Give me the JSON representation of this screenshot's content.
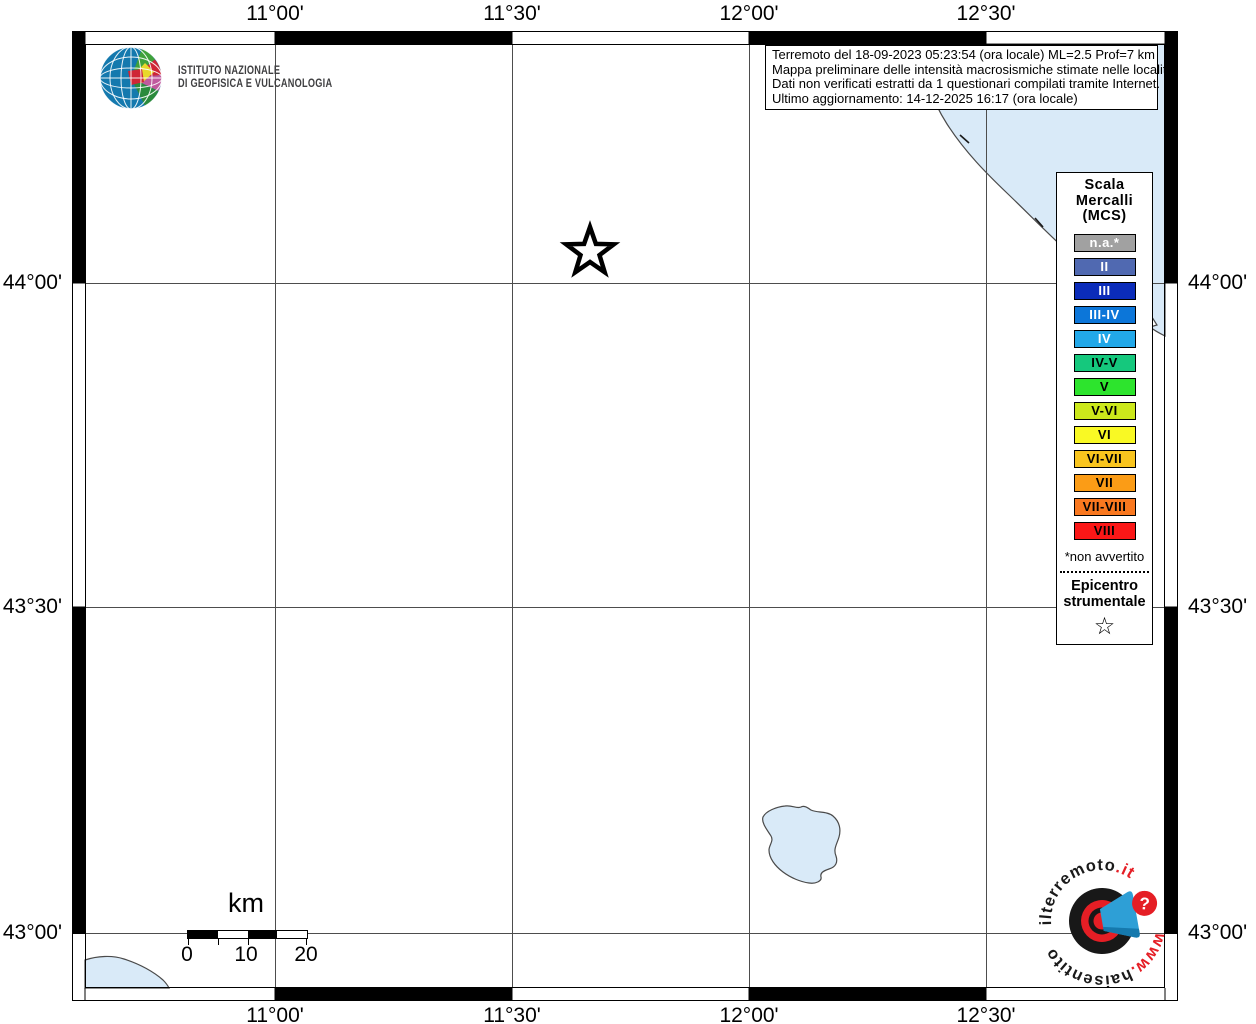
{
  "header": {
    "ingv": {
      "name_line1": "ISTITUTO NAZIONALE",
      "name_line2": "DI GEOFISICA E VULCANOLOGIA"
    },
    "info_box": {
      "line1": "Terremoto del 18-09-2023 05:23:54 (ora locale) ML=2.5 Prof=7 km",
      "line2": "Mappa preliminare delle intensità macrosismiche stimate nelle località",
      "line3": "Dati non verificati estratti da 1 questionari compilati tramite Internet.",
      "line4": "Ultimo aggiornamento: 14-12-2025 16:17 (ora locale)"
    }
  },
  "axes": {
    "top": [
      "11°00'",
      "11°30'",
      "12°00'",
      "12°30'"
    ],
    "bottom": [
      "11°00'",
      "11°30'",
      "12°00'",
      "12°30'"
    ],
    "left": [
      "44°00'",
      "43°30'",
      "43°00'"
    ],
    "right": [
      "44°00'",
      "43°30'",
      "43°00'"
    ]
  },
  "legend": {
    "title_lines": [
      "Scala",
      "Mercalli",
      "(MCS)"
    ],
    "items": [
      {
        "label": "n.a.*",
        "color": "#a1a1a1",
        "text_color": "#ffffff"
      },
      {
        "label": "II",
        "color": "#5069b1",
        "text_color": "#ffffff"
      },
      {
        "label": "III",
        "color": "#0b2cba",
        "text_color": "#ffffff"
      },
      {
        "label": "III-IV",
        "color": "#0c76d9",
        "text_color": "#ffffff"
      },
      {
        "label": "IV",
        "color": "#22a8e9",
        "text_color": "#ffffff"
      },
      {
        "label": "IV-V",
        "color": "#15c87d",
        "text_color": "#000000"
      },
      {
        "label": "V",
        "color": "#2de42d",
        "text_color": "#000000"
      },
      {
        "label": "V-VI",
        "color": "#cce81b",
        "text_color": "#000000"
      },
      {
        "label": "VI",
        "color": "#f9f924",
        "text_color": "#000000"
      },
      {
        "label": "VI-VII",
        "color": "#f9c51e",
        "text_color": "#000000"
      },
      {
        "label": "VII",
        "color": "#fb9c16",
        "text_color": "#000000"
      },
      {
        "label": "VII-VIII",
        "color": "#f9781f",
        "text_color": "#000000"
      },
      {
        "label": "VIII",
        "color": "#fb1717",
        "text_color": "#000000"
      }
    ],
    "footnote": "*non avvertito",
    "epicenter_line1": "Epicentro",
    "epicenter_line2": "strumentale",
    "epicenter_symbol": "☆"
  },
  "scale_bar": {
    "unit": "km",
    "tick_labels": [
      "0",
      "10",
      "20"
    ]
  },
  "watermark": {
    "arc_top_black": "ilterremoto",
    "arc_top_red": ".it",
    "arc_bottom_red": "www.",
    "arc_bottom_black": "haisentito",
    "question_mark": "?"
  },
  "colors": {
    "water": "#d9eaf8",
    "coastline": "#4a4a4a",
    "grid": "#4d4d4d",
    "frame": "#000000",
    "logo_red": "#e51e25",
    "logo_blue": "#2e9fd6"
  },
  "map": {
    "epicenter_marker": "star-outline"
  }
}
